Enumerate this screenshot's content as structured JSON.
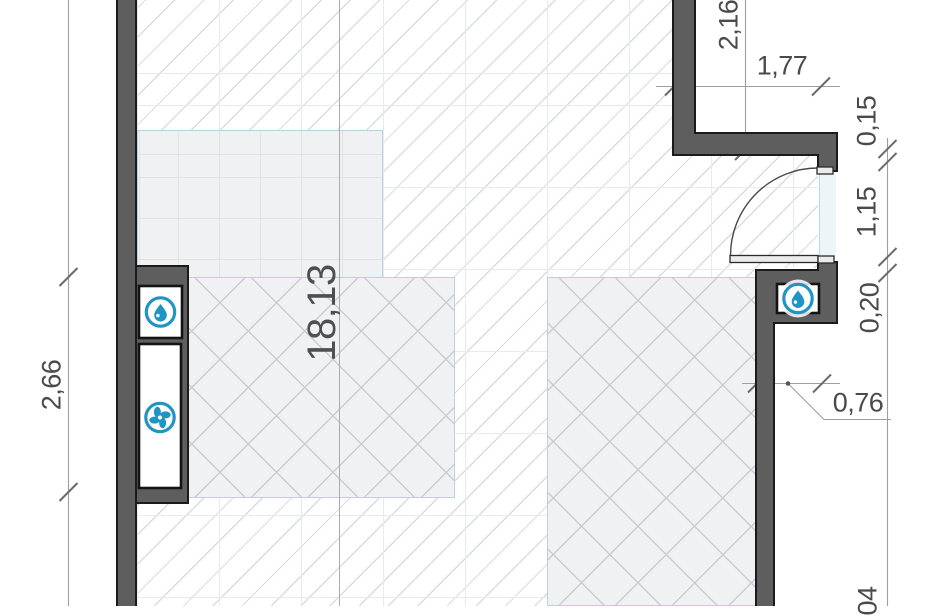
{
  "plan": {
    "room": {
      "area_label": "18,13"
    },
    "dims": {
      "left_vertical": "2,66",
      "top_vertical": "2,16",
      "top_horizontal": "1,77",
      "chain_0": "0,15",
      "chain_1": "1,15",
      "chain_2": "0,20",
      "chain_partial_bottom": "04",
      "recess_width": "0,76"
    },
    "icons": {
      "left_niche_top": "water-drop",
      "left_niche_bottom": "fan",
      "right_niche": "water-drop"
    },
    "colors": {
      "wall_fill": "#5e5e5e",
      "wall_outline": "#1b1b1b",
      "accent_blue": "#2095c4",
      "region_border": "#b7d2e1",
      "region_fill": "#f0f1f3"
    }
  }
}
